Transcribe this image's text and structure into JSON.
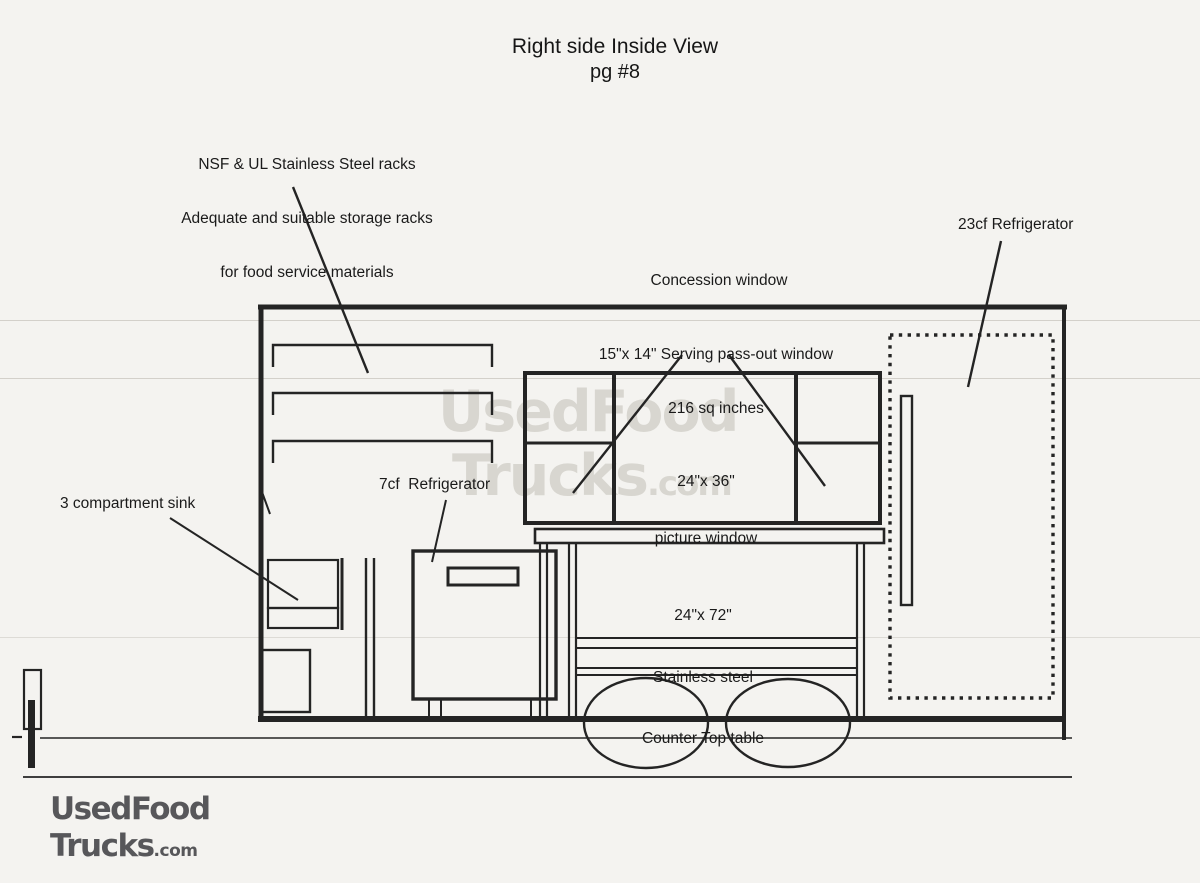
{
  "title": {
    "line1": "Right side Inside View",
    "line2": "pg #8"
  },
  "annotations": {
    "racks": {
      "line1": "NSF & UL Stainless Steel racks",
      "line2": "Adequate and suitable storage racks",
      "line3": "for food service materials"
    },
    "refrigerator_23cf": "23cf Refrigerator",
    "concession_window": "Concession window",
    "serving_window": {
      "line1": "15\"x 14\" Serving pass-out window",
      "line2": "216 sq inches"
    },
    "picture_window": {
      "line1": "24\"x 36\"",
      "line2": "picture window"
    },
    "sink": "3 compartment sink",
    "refrigerator_7cf": "7cf  Refrigerator",
    "counter": {
      "line1": "24\"x 72\"",
      "line2": "Stainless steel",
      "line3": "Counter Top table"
    }
  },
  "watermark": {
    "line1": "UsedFood",
    "line2_main": "Trucks",
    "line2_suffix": ".com"
  },
  "logo": {
    "line1": "UsedFood",
    "line2_main": "Trucks",
    "line2_suffix": ".com"
  },
  "colors": {
    "paper": "#f4f3f0",
    "ink": "#242424",
    "watermark": "#d8d6d0",
    "logo_text": "#57575a"
  }
}
